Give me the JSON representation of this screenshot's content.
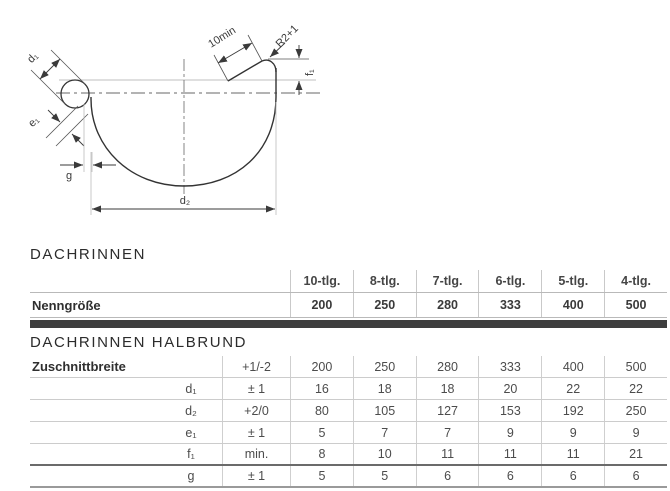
{
  "diagram": {
    "d1": "d₁",
    "e1": "e₁",
    "g": "g",
    "d2": "d₂",
    "flat": "10min",
    "radius": "R2+1",
    "f1": "f₁"
  },
  "table1": {
    "title": "DACHRINNEN",
    "col_headers": [
      "10-tlg.",
      "8-tlg.",
      "7-tlg.",
      "6-tlg.",
      "5-tlg.",
      "4-tlg."
    ],
    "row_label": "Nenngröße",
    "row_values": [
      "200",
      "250",
      "280",
      "333",
      "400",
      "500"
    ]
  },
  "table2": {
    "title": "DACHRINNEN HALBRUND",
    "rows": [
      {
        "label": "Zuschnittbreite",
        "param": "",
        "tol": "+1/-2",
        "v": [
          "200",
          "250",
          "280",
          "333",
          "400",
          "500"
        ]
      },
      {
        "label": "",
        "param": "d₁",
        "tol": "± 1",
        "v": [
          "16",
          "18",
          "18",
          "20",
          "22",
          "22"
        ]
      },
      {
        "label": "",
        "param": "d₂",
        "tol": "+2/0",
        "v": [
          "80",
          "105",
          "127",
          "153",
          "192",
          "250"
        ]
      },
      {
        "label": "",
        "param": "e₁",
        "tol": "± 1",
        "v": [
          "5",
          "7",
          "7",
          "9",
          "9",
          "9"
        ]
      },
      {
        "label": "",
        "param": "f₁",
        "tol": "min.",
        "v": [
          "8",
          "10",
          "11",
          "11",
          "11",
          "21"
        ]
      },
      {
        "label": "",
        "param": "g",
        "tol": "± 1",
        "v": [
          "5",
          "5",
          "6",
          "6",
          "6",
          "6"
        ]
      }
    ]
  }
}
